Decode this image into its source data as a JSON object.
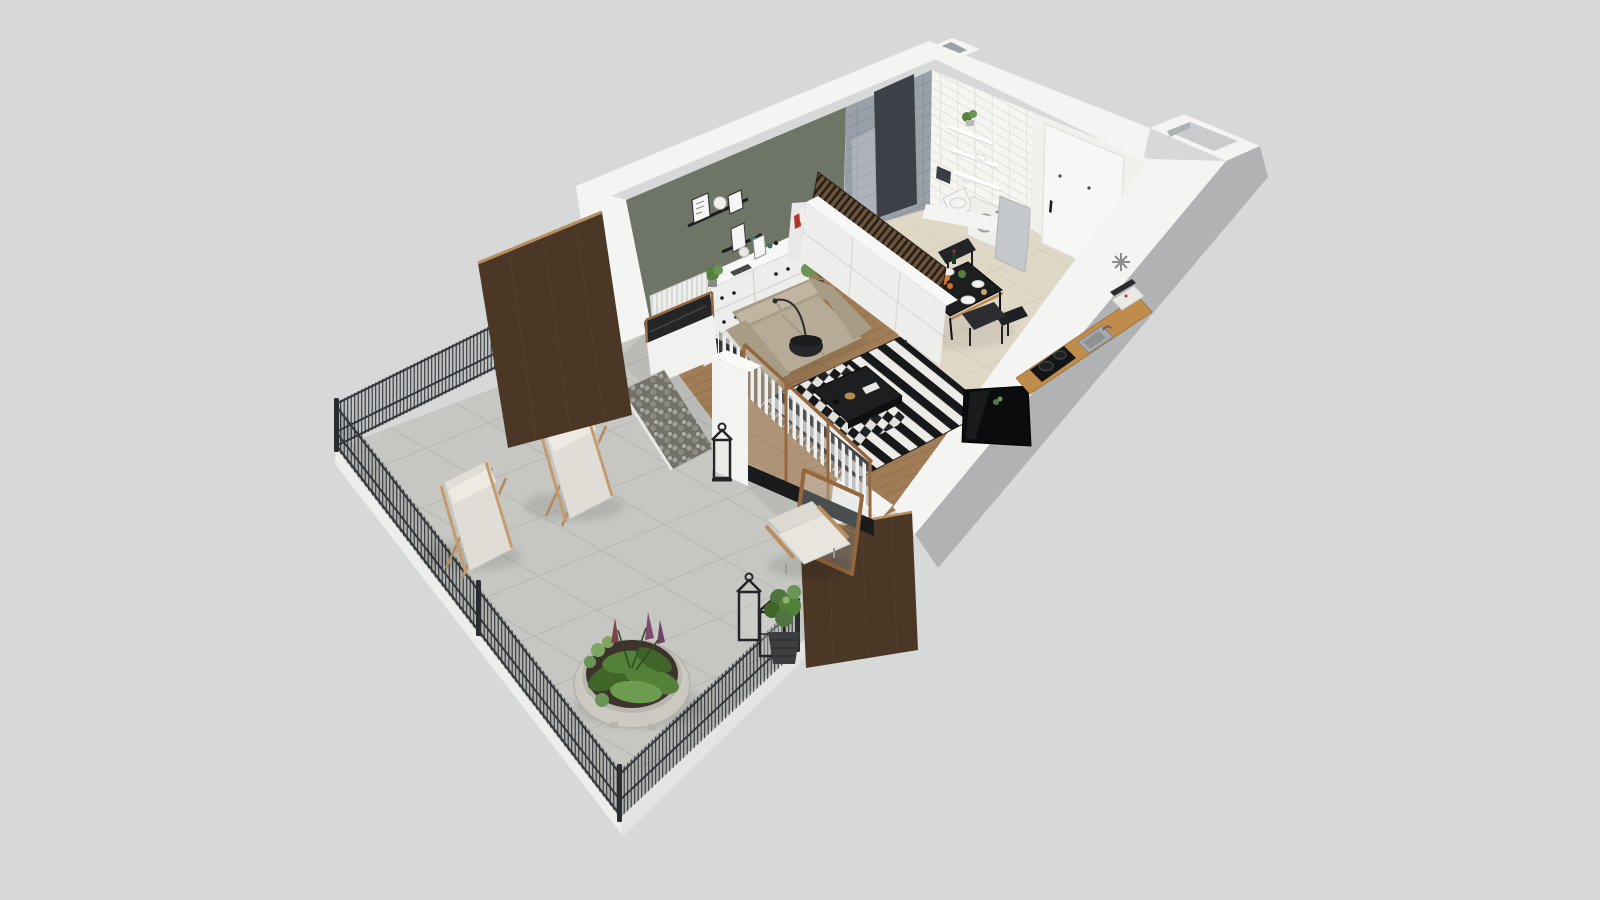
{
  "palette": {
    "background": "#d7d8d8",
    "wall_top_white": "#f4f4f2",
    "wall_face_light": "#ededeb",
    "wall_outer_gray": "#b0b2b4",
    "accent_wall_green": "#6e7466",
    "bath_tile_gray": "#99a0a8",
    "bath_column_dark": "#3c4147",
    "bath_tile_white": "#f5f5f2",
    "entry_door_white": "#f7f7f5",
    "hall_wall_white": "#f0f0ed",
    "floor_wood": "#a07c57",
    "floor_wood_line": "#8a6a48",
    "floor_tile_beige": "#e0d8c7",
    "floor_tile_line": "#cdc5b2",
    "terrace_tile": "#c6c7c3",
    "terrace_tile_line": "#b4b5b1",
    "terrace_edge_white": "#ededeb",
    "fence_dark": "#2f3336",
    "fence_post": "#2a2d30",
    "wood_panel": "#4a3726",
    "wood_panel_edge": "#b98e5e",
    "window_frame_wood": "#96673c",
    "counter_wood": "#c08c4c",
    "rug_black": "#17181a",
    "rug_white": "#ecebe7",
    "sofa_beige": "#b6ab96",
    "sofa_shadow": "#a79c86",
    "sofa_cushion": "#c0b5a0",
    "furniture_white": "#ededeb",
    "table_black": "#1d1e20",
    "chair_black": "#2c2d31",
    "appliance_white": "#efefec",
    "plant_green": "#54813a",
    "plant_green_light": "#7fa763",
    "plant_purple": "#7c4a6d",
    "soil_dark": "#3e332c",
    "planter_pot": "#cbc9c2",
    "lantern_black": "#232527",
    "gravel_dark": "#73726a",
    "glass_tint": "#e8eff0",
    "marker_gray": "#8a8d8f",
    "gold_accent": "#b98a4e",
    "orange_accent": "#d2702b"
  },
  "icons": {
    "freezer_marker": "snowflake-icon"
  },
  "scene": {
    "type": "3d-floorplan-render",
    "building": {
      "rooms": [
        "living-room",
        "kitchen-dining",
        "bathroom",
        "entry-hall"
      ],
      "furniture": [
        "sofa",
        "floor-lamp",
        "coffee-table",
        "striped-rug",
        "dresser",
        "picture-ledge",
        "sideboard",
        "storage-rack",
        "dining-table",
        "dining-chairs",
        "tv-panel",
        "kitchen-counter",
        "cooktop",
        "sink",
        "coffee-machine",
        "washing-machine",
        "toilet",
        "shower",
        "wall-shelves",
        "entry-door",
        "bathroom-door",
        "radiator",
        "vertical-blinds",
        "glazed-wall",
        "ventilation-shaft"
      ]
    },
    "terrace": {
      "items": [
        "concrete-tile-deck",
        "mesh-fence",
        "wood-privacy-panel-north",
        "wood-privacy-panel-east",
        "lounge-chair-left",
        "lounge-chair-right",
        "round-planter",
        "lantern-group",
        "plant-basket",
        "outdoor-armchair",
        "gravel-strip",
        "open-glass-door",
        "white-pillar"
      ]
    }
  }
}
